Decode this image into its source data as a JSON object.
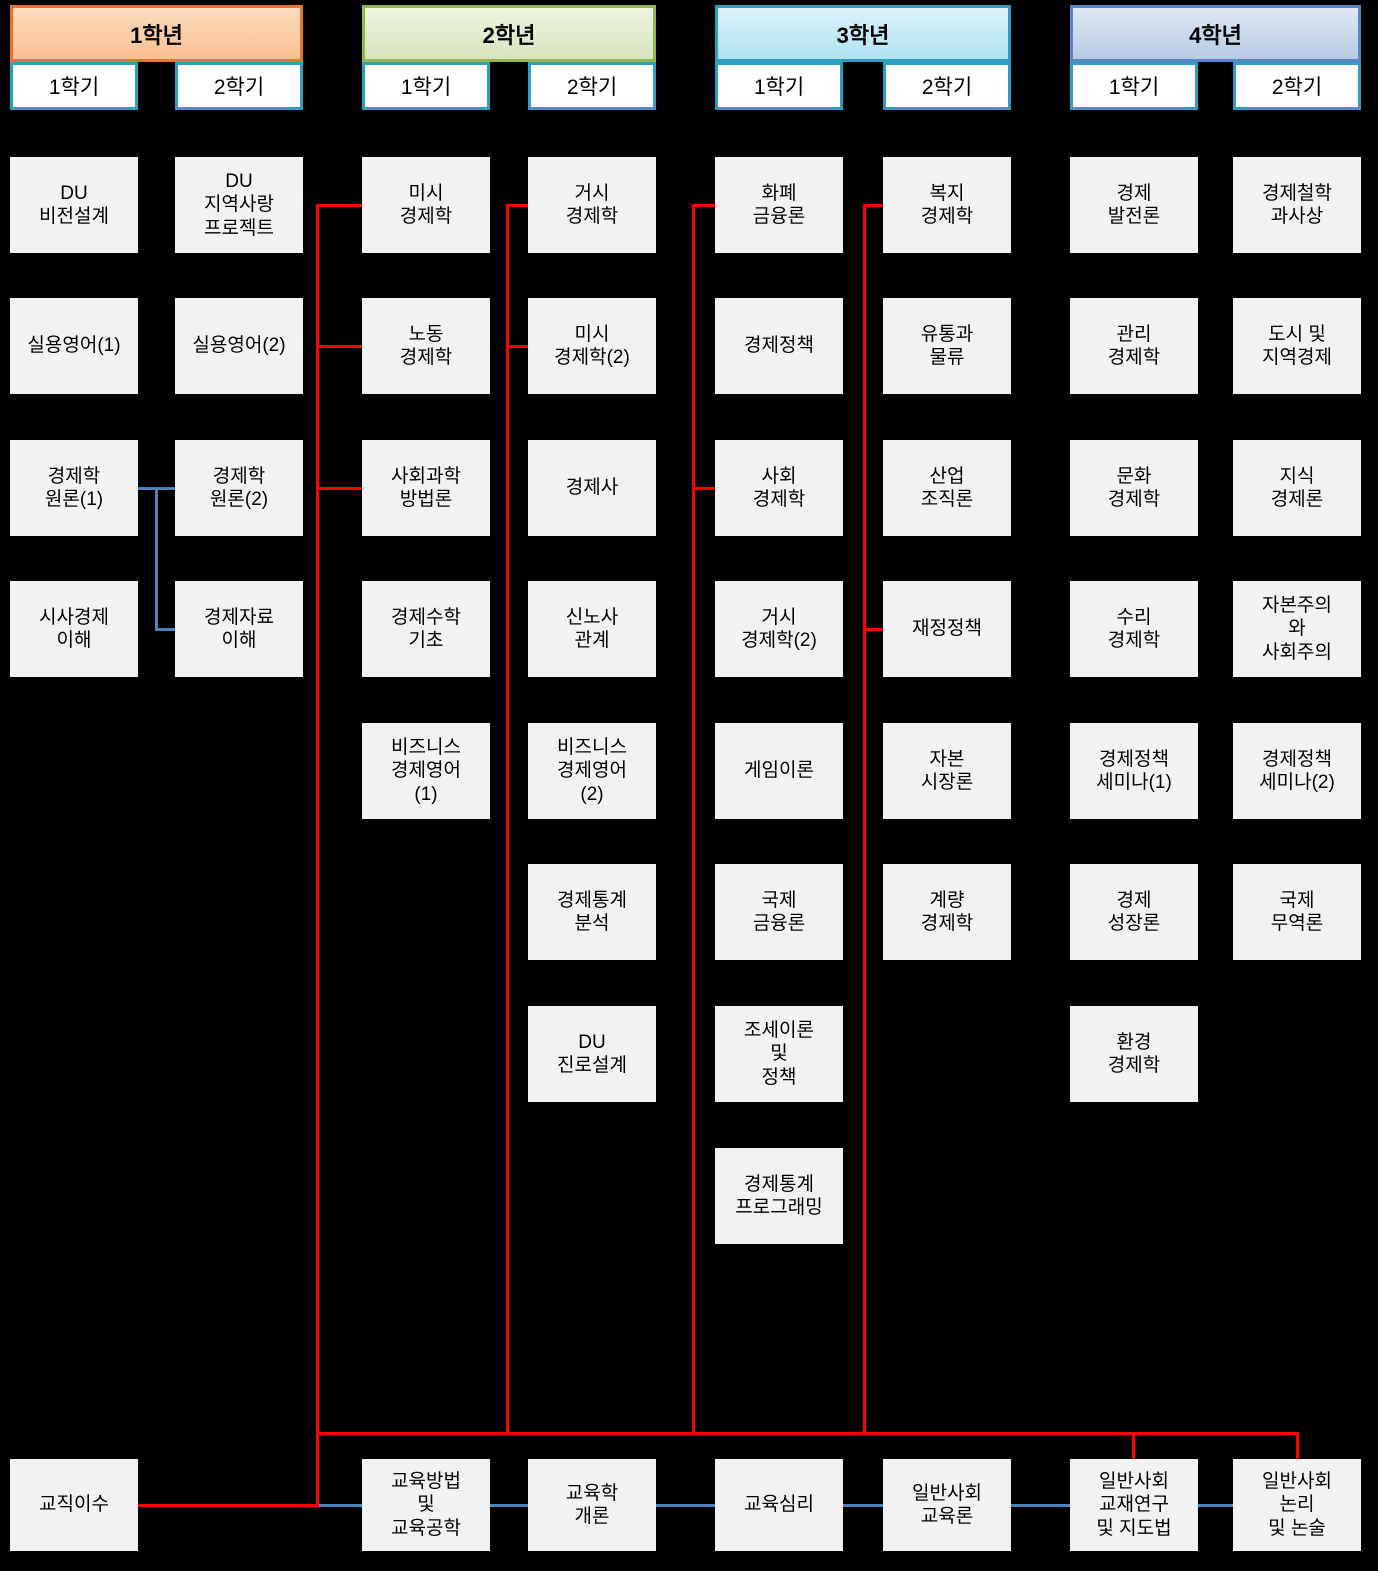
{
  "title": "경제학과 교육과정 이수체계도",
  "colors": {
    "background": "#000000",
    "red": "#ff0000",
    "blue": "#4f81bd",
    "box_bg": "#f2f2f2",
    "box_text": "#000000",
    "semester_border": "#2f9fc1",
    "semester_bg": "#ffffff"
  },
  "years": [
    {
      "label": "1학년",
      "theme": {
        "top": "#fcdcc0",
        "bottom": "#fac090",
        "border": "#e8732a"
      },
      "semesters": [
        {
          "label": "1학기",
          "courses": [
            {
              "row": 1,
              "label": "DU\n비전설계"
            },
            {
              "row": 2,
              "label": "실용영어(1)"
            },
            {
              "row": 3,
              "label": "경제학\n원론(1)"
            },
            {
              "row": 4,
              "label": "시사경제\n이해"
            }
          ]
        },
        {
          "label": "2학기",
          "courses": [
            {
              "row": 1,
              "label": "DU\n지역사랑\n프로젝트"
            },
            {
              "row": 2,
              "label": "실용영어(2)"
            },
            {
              "row": 3,
              "label": "경제학\n원론(2)"
            },
            {
              "row": 4,
              "label": "경제자료\n이해"
            }
          ]
        }
      ]
    },
    {
      "label": "2학년",
      "theme": {
        "top": "#eef5e0",
        "bottom": "#d6e4bc",
        "border": "#94b64e"
      },
      "semesters": [
        {
          "label": "1학기",
          "courses": [
            {
              "row": 1,
              "label": "미시\n경제학"
            },
            {
              "row": 2,
              "label": "노동\n경제학"
            },
            {
              "row": 3,
              "label": "사회과학\n방법론"
            },
            {
              "row": 4,
              "label": "경제수학\n기초"
            },
            {
              "row": 5,
              "label": "비즈니스\n경제영어\n(1)"
            }
          ]
        },
        {
          "label": "2학기",
          "courses": [
            {
              "row": 1,
              "label": "거시\n경제학"
            },
            {
              "row": 2,
              "label": "미시\n경제학(2)"
            },
            {
              "row": 3,
              "label": "경제사"
            },
            {
              "row": 4,
              "label": "신노사\n관계"
            },
            {
              "row": 5,
              "label": "비즈니스\n경제영어\n(2)"
            },
            {
              "row": 6,
              "label": "경제통계\n분석"
            },
            {
              "row": 7,
              "label": "DU\n진로설계"
            }
          ]
        }
      ]
    },
    {
      "label": "3학년",
      "theme": {
        "top": "#ddf3fa",
        "bottom": "#b0e3f2",
        "border": "#2f9fc1"
      },
      "semesters": [
        {
          "label": "1학기",
          "courses": [
            {
              "row": 1,
              "label": "화폐\n금융론"
            },
            {
              "row": 2,
              "label": "경제정책"
            },
            {
              "row": 3,
              "label": "사회\n경제학"
            },
            {
              "row": 4,
              "label": "거시\n경제학(2)"
            },
            {
              "row": 5,
              "label": "게임이론"
            },
            {
              "row": 6,
              "label": "국제\n금융론"
            },
            {
              "row": 7,
              "label": "조세이론\n및\n정책"
            },
            {
              "row": 8,
              "label": "경제통계\n프로그래밍"
            }
          ]
        },
        {
          "label": "2학기",
          "courses": [
            {
              "row": 1,
              "label": "복지\n경제학"
            },
            {
              "row": 2,
              "label": "유통과\n물류"
            },
            {
              "row": 3,
              "label": "산업\n조직론"
            },
            {
              "row": 4,
              "label": "재정정책"
            },
            {
              "row": 5,
              "label": "자본\n시장론"
            },
            {
              "row": 6,
              "label": "계량\n경제학"
            }
          ]
        }
      ]
    },
    {
      "label": "4학년",
      "theme": {
        "top": "#dfe8f4",
        "bottom": "#b7cbe3",
        "border": "#5b84c4"
      },
      "semesters": [
        {
          "label": "1학기",
          "courses": [
            {
              "row": 1,
              "label": "경제\n발전론"
            },
            {
              "row": 2,
              "label": "관리\n경제학"
            },
            {
              "row": 3,
              "label": "문화\n경제학"
            },
            {
              "row": 4,
              "label": "수리\n경제학"
            },
            {
              "row": 5,
              "label": "경제정책\n세미나(1)"
            },
            {
              "row": 6,
              "label": "경제\n성장론"
            },
            {
              "row": 7,
              "label": "환경\n경제학"
            }
          ]
        },
        {
          "label": "2학기",
          "courses": [
            {
              "row": 1,
              "label": "경제철학\n과사상"
            },
            {
              "row": 2,
              "label": "도시 및\n지역경제"
            },
            {
              "row": 3,
              "label": "지식\n경제론"
            },
            {
              "row": 4,
              "label": "자본주의\n와\n사회주의"
            },
            {
              "row": 5,
              "label": "경제정책\n세미나(2)"
            },
            {
              "row": 6,
              "label": "국제\n무역론"
            }
          ]
        }
      ]
    }
  ],
  "bottom_row": {
    "certification": {
      "label": "교직이수"
    },
    "courses": [
      {
        "col": 3,
        "label": "교육방법\n및\n교육공학"
      },
      {
        "col": 4,
        "label": "교육학\n개론"
      },
      {
        "col": 5,
        "label": "교육심리"
      },
      {
        "col": 6,
        "label": "일반사회\n교육론"
      },
      {
        "col": 7,
        "label": "일반사회\n교재연구\n및 지도법"
      },
      {
        "col": 8,
        "label": "일반사회\n논리\n및 논술"
      }
    ]
  },
  "connectors": {
    "segments": [
      {
        "name": "vbus-1",
        "color": "red",
        "x": 316,
        "y": 204,
        "w": 3,
        "h": 1303
      },
      {
        "name": "vbus-2",
        "color": "red",
        "x": 506,
        "y": 204,
        "w": 3,
        "h": 1231
      },
      {
        "name": "vbus-3",
        "color": "red",
        "x": 692,
        "y": 204,
        "w": 3,
        "h": 1231
      },
      {
        "name": "vbus-4",
        "color": "red",
        "x": 863,
        "y": 204,
        "w": 3,
        "h": 1231
      },
      {
        "name": "stub-misi-gyeongjehak",
        "color": "red",
        "x": 319,
        "y": 204,
        "w": 43,
        "h": 3
      },
      {
        "name": "stub-nodong-gyeongjehak",
        "color": "red",
        "x": 319,
        "y": 345,
        "w": 43,
        "h": 3
      },
      {
        "name": "stub-sahoegwahak-bangbeomnon",
        "color": "red",
        "x": 319,
        "y": 487,
        "w": 43,
        "h": 3
      },
      {
        "name": "stub-geosi-gyeongjehak",
        "color": "red",
        "x": 509,
        "y": 204,
        "w": 19,
        "h": 3
      },
      {
        "name": "stub-misi-gyeongjehak-2",
        "color": "red",
        "x": 509,
        "y": 345,
        "w": 19,
        "h": 3
      },
      {
        "name": "stub-hwapye-geumyungnon",
        "color": "red",
        "x": 695,
        "y": 204,
        "w": 20,
        "h": 3
      },
      {
        "name": "stub-sahoe-gyeongjehak",
        "color": "red",
        "x": 695,
        "y": 487,
        "w": 20,
        "h": 3
      },
      {
        "name": "stub-bokji-gyeongjehak",
        "color": "red",
        "x": 866,
        "y": 204,
        "w": 17,
        "h": 3
      },
      {
        "name": "stub-jaejeong-jeongchaek",
        "color": "red",
        "x": 866,
        "y": 628,
        "w": 17,
        "h": 3
      },
      {
        "name": "hbus-bottom",
        "color": "red",
        "x": 316,
        "y": 1432,
        "w": 983,
        "h": 3
      },
      {
        "name": "drop-gyojaeyeongu",
        "color": "red",
        "x": 1132,
        "y": 1432,
        "w": 3,
        "h": 27
      },
      {
        "name": "drop-nonri-nonsul",
        "color": "red",
        "x": 1296,
        "y": 1432,
        "w": 3,
        "h": 27
      },
      {
        "name": "link-gyojik-isu",
        "color": "red",
        "x": 138,
        "y": 1504,
        "w": 178,
        "h": 3
      },
      {
        "name": "link-wonron-1-2",
        "color": "blue",
        "x": 138,
        "y": 487,
        "w": 37,
        "h": 3
      },
      {
        "name": "drop-wonron",
        "color": "blue",
        "x": 155,
        "y": 487,
        "w": 3,
        "h": 144
      },
      {
        "name": "stub-gyeongjejaryo",
        "color": "blue",
        "x": 158,
        "y": 628,
        "w": 17,
        "h": 3
      },
      {
        "name": "chain-bottom-1",
        "color": "blue",
        "x": 319,
        "y": 1504,
        "w": 43,
        "h": 3
      },
      {
        "name": "chain-bottom-2",
        "color": "blue",
        "x": 490,
        "y": 1504,
        "w": 38,
        "h": 3
      },
      {
        "name": "chain-bottom-3",
        "color": "blue",
        "x": 656,
        "y": 1504,
        "w": 59,
        "h": 3
      },
      {
        "name": "chain-bottom-4",
        "color": "blue",
        "x": 843,
        "y": 1504,
        "w": 40,
        "h": 3
      },
      {
        "name": "chain-bottom-5",
        "color": "blue",
        "x": 1011,
        "y": 1504,
        "w": 59,
        "h": 3
      },
      {
        "name": "chain-bottom-6",
        "color": "blue",
        "x": 1198,
        "y": 1504,
        "w": 35,
        "h": 3
      }
    ]
  }
}
